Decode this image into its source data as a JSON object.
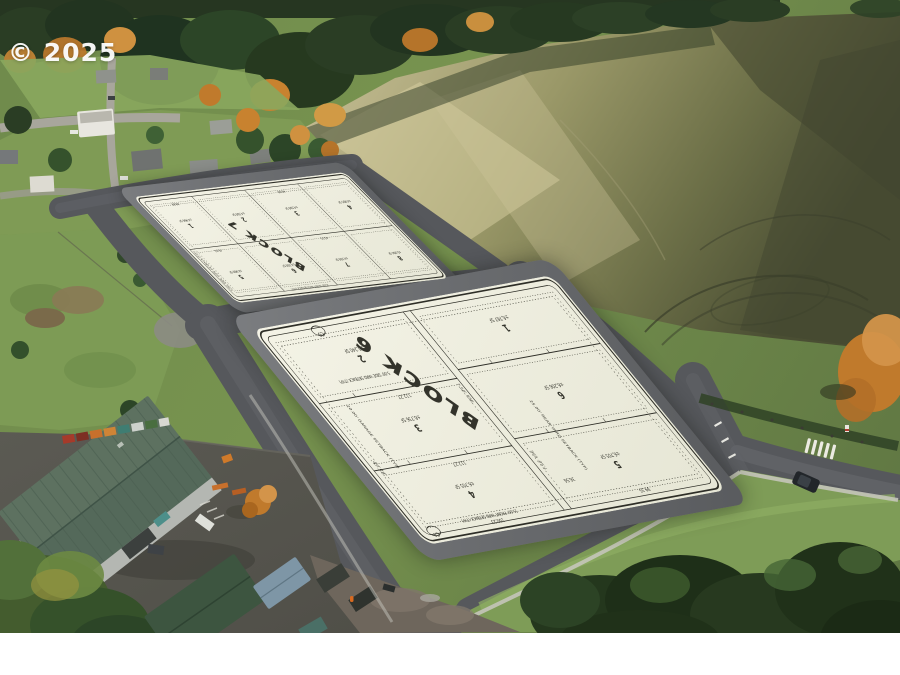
{
  "watermark": "© 2025",
  "palette": {
    "sheet": "#f1f0e3",
    "asphalt": "#56585c",
    "field_light": "#cdc49c",
    "field_dark": "#4a4e33",
    "tree_dark": "#24371d",
    "roof_green": "#5d7160",
    "grass": "#7e9c57"
  },
  "plat": {
    "setbacks": {
      "front": "15.00' FRONT YARD SETBACK (TYP)",
      "garage": "20.00' GARAGE SETBACK (TYP)",
      "side": "5.00' SIDE YARD SETBACK (TYP)",
      "rear": "25.00' REAR YARD SETBACK (TYP)",
      "sse": "7.50' SSE"
    },
    "block7": {
      "title": "BLOCK 7",
      "lots": [
        {
          "number": "1",
          "area": "±4,996 SF"
        },
        {
          "number": "2",
          "area": "±4,500 SF"
        },
        {
          "number": "3",
          "area": "±4,500 SF"
        },
        {
          "number": "4",
          "area": "±4,995 SF"
        },
        {
          "number": "5",
          "area": "±4,999 SF"
        },
        {
          "number": "6",
          "area": "±4,500 SF"
        },
        {
          "number": "7",
          "area": "±4,500 SF"
        },
        {
          "number": "8",
          "area": "±5,004 SF"
        }
      ],
      "dims": [
        "45.51",
        "45.51",
        "40.00",
        "40.00"
      ]
    },
    "block6": {
      "title": "BLOCK 6",
      "lots": [
        {
          "number": "1",
          "area": "±6,767 SF"
        },
        {
          "number": "2",
          "area": "±6,240 SF"
        },
        {
          "number": "3",
          "area": "±6,736 SF"
        },
        {
          "number": "4",
          "area": "±6,705 SF"
        },
        {
          "number": "5",
          "area": "±6,705 SF"
        },
        {
          "number": "6",
          "area": "±6,206 SF"
        }
      ],
      "dims": [
        "112.27",
        "112.27",
        "100.23",
        "47.58",
        "99.35",
        "36.56"
      ],
      "curves": [
        "C3",
        "C4"
      ]
    }
  }
}
